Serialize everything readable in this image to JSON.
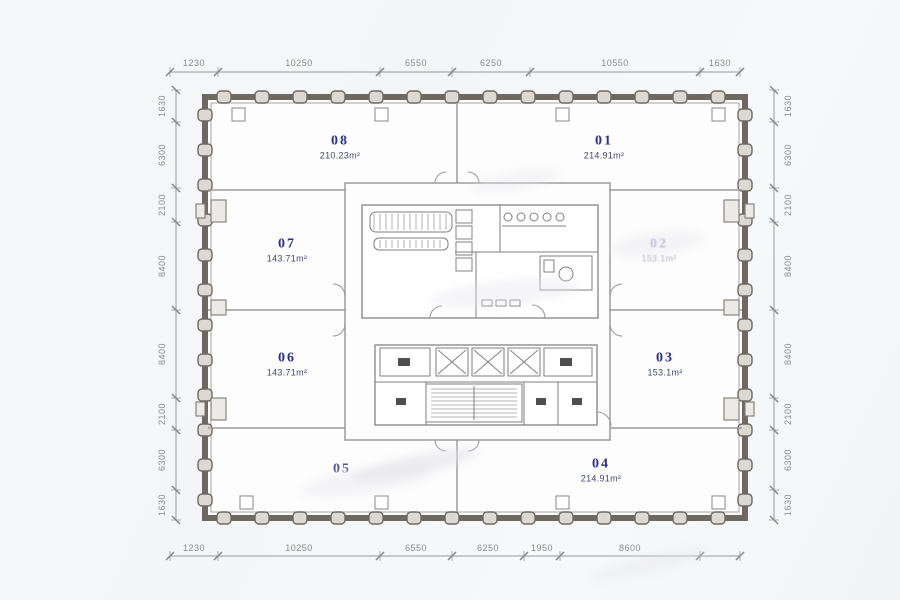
{
  "title": "office-floor-plan",
  "units": {
    "u01": {
      "id": "01",
      "area": "214.91m²"
    },
    "u02": {
      "id": "02",
      "area": "153.1m²"
    },
    "u03": {
      "id": "03",
      "area": "153.1m²"
    },
    "u04": {
      "id": "04",
      "area": "214.91m²"
    },
    "u05": {
      "id": "05",
      "area": ""
    },
    "u06": {
      "id": "06",
      "area": "143.71m²"
    },
    "u07": {
      "id": "07",
      "area": "143.71m²"
    },
    "u08": {
      "id": "08",
      "area": "210.23m²"
    }
  },
  "dimensions": {
    "top": [
      "1230",
      "10250",
      "6550",
      "6250",
      "10550",
      "1630"
    ],
    "bottom": [
      "1230",
      "10250",
      "6550",
      "6250",
      "1950",
      "8600"
    ],
    "left": [
      "1630",
      "6300",
      "2100",
      "8400",
      "8400",
      "2100",
      "6300",
      "1630"
    ],
    "right": [
      "1630",
      "6300",
      "2100",
      "8400",
      "8400",
      "2100",
      "6300",
      "1630"
    ]
  },
  "colors": {
    "unit_number": "#2d2f8e",
    "dimension_text": "#8a8a8a",
    "wall": "#6e6862"
  }
}
